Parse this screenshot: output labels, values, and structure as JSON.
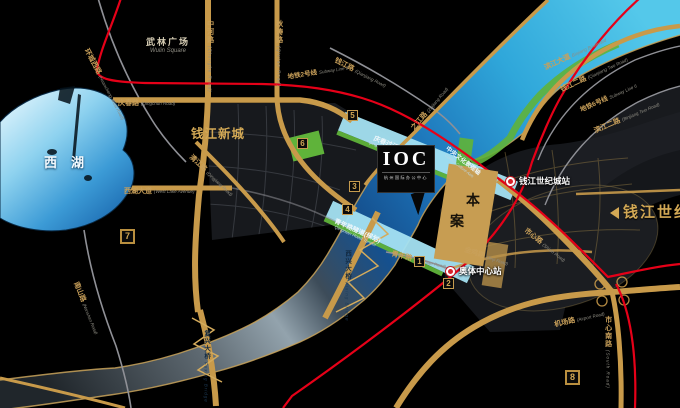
{
  "areas": {
    "west_lake": {
      "zh": "西湖"
    },
    "wulin_square": {
      "zh": "武林广场",
      "en": "Wulin Square"
    },
    "qianjiang_new_town": {
      "zh": "钱江新城"
    },
    "qianjiang_century_city": {
      "zh": "钱江世纪城"
    }
  },
  "site": {
    "logo": "IOC",
    "logo_sub": "杭州国际办公中心",
    "marker_char_1": "本",
    "marker_char_2": "案"
  },
  "stations": {
    "qianjiang_century_city": {
      "name": "钱江世纪城站"
    },
    "olympic_center": {
      "name": "奥体中心站"
    }
  },
  "metro_lines": {
    "line2": {
      "zh": "地铁2号线",
      "en": "Subway Line 2"
    },
    "line6": {
      "zh": "地铁6号线",
      "en": "Subway Line 6"
    }
  },
  "tunnels": {
    "qingchun": {
      "zh": "庆春过江隧道",
      "en": "Qingchun River Tunnel"
    },
    "qingnian": {
      "zh": "青年路隧道(规划)",
      "en": "Qingnian Road Tunnel"
    }
  },
  "bridges": {
    "xixing": {
      "zh": "西兴大桥",
      "en": "Xixing Bridge"
    },
    "fuxing": {
      "zh": "复兴大桥",
      "en": "Fuxing Bridge"
    }
  },
  "axis": {
    "zh": "中央文化景观轴",
    "en": "Central Culture Axis"
  },
  "roads": {
    "huancheng_west": {
      "zh": "环城西路",
      "en": "(Huancheng West Road)"
    },
    "zhonghe": {
      "zh": "中河路",
      "en": "(Zhonghe Road)"
    },
    "qiutao": {
      "zh": "秋涛路",
      "en": "(Qiutao Road)"
    },
    "qingchun": {
      "zh": "庆春路",
      "en": "(Qingchun Road)"
    },
    "west_lake_avenue": {
      "zh": "西湖大道",
      "en": "(West Lake Avenue)"
    },
    "qingjiang": {
      "zh": "清江路",
      "en": "(Qingjiang Road)"
    },
    "qianjiang": {
      "zh": "钱江路",
      "en": "(Qianjiang Road)"
    },
    "zhijiang": {
      "zh": "之江路",
      "en": "(Zhijiang Road)"
    },
    "binjiang_blvd": {
      "zh": "滨江大道",
      "en": "Binjiang Boulevard"
    },
    "qianjiang_2": {
      "zh": "钱江二路",
      "en": "(Qianjiang Two Road)"
    },
    "binjiang_2": {
      "zh": "滨江二路",
      "en": "(Binjiang Two Road)"
    },
    "shixin": {
      "zh": "市心路",
      "en": "(Shixin Road)"
    },
    "jinji": {
      "zh": "金鸡路",
      "en": "(Jinji Road)"
    },
    "airport": {
      "zh": "机场路",
      "en": "(Airport Road)"
    },
    "shixin_south": {
      "zh": "市心南路",
      "en": "(South Road)"
    },
    "nanshan": {
      "zh": "南山路",
      "en": "(Nanshan Road)"
    },
    "qingnian": {
      "zh": "青年路",
      "en": "(Qingnian Road)"
    }
  },
  "badges": {
    "b1": "1",
    "b2": "2",
    "b3": "3",
    "b4": "4",
    "b5": "5",
    "b6": "6",
    "b7": "7",
    "b8": "8"
  },
  "colors": {
    "gold_road": "#c89a4a",
    "metro_red": "#e60018",
    "green": "#5fb33a",
    "river_cyan": "#45c0e8",
    "gold_text": "#c9a05a"
  }
}
